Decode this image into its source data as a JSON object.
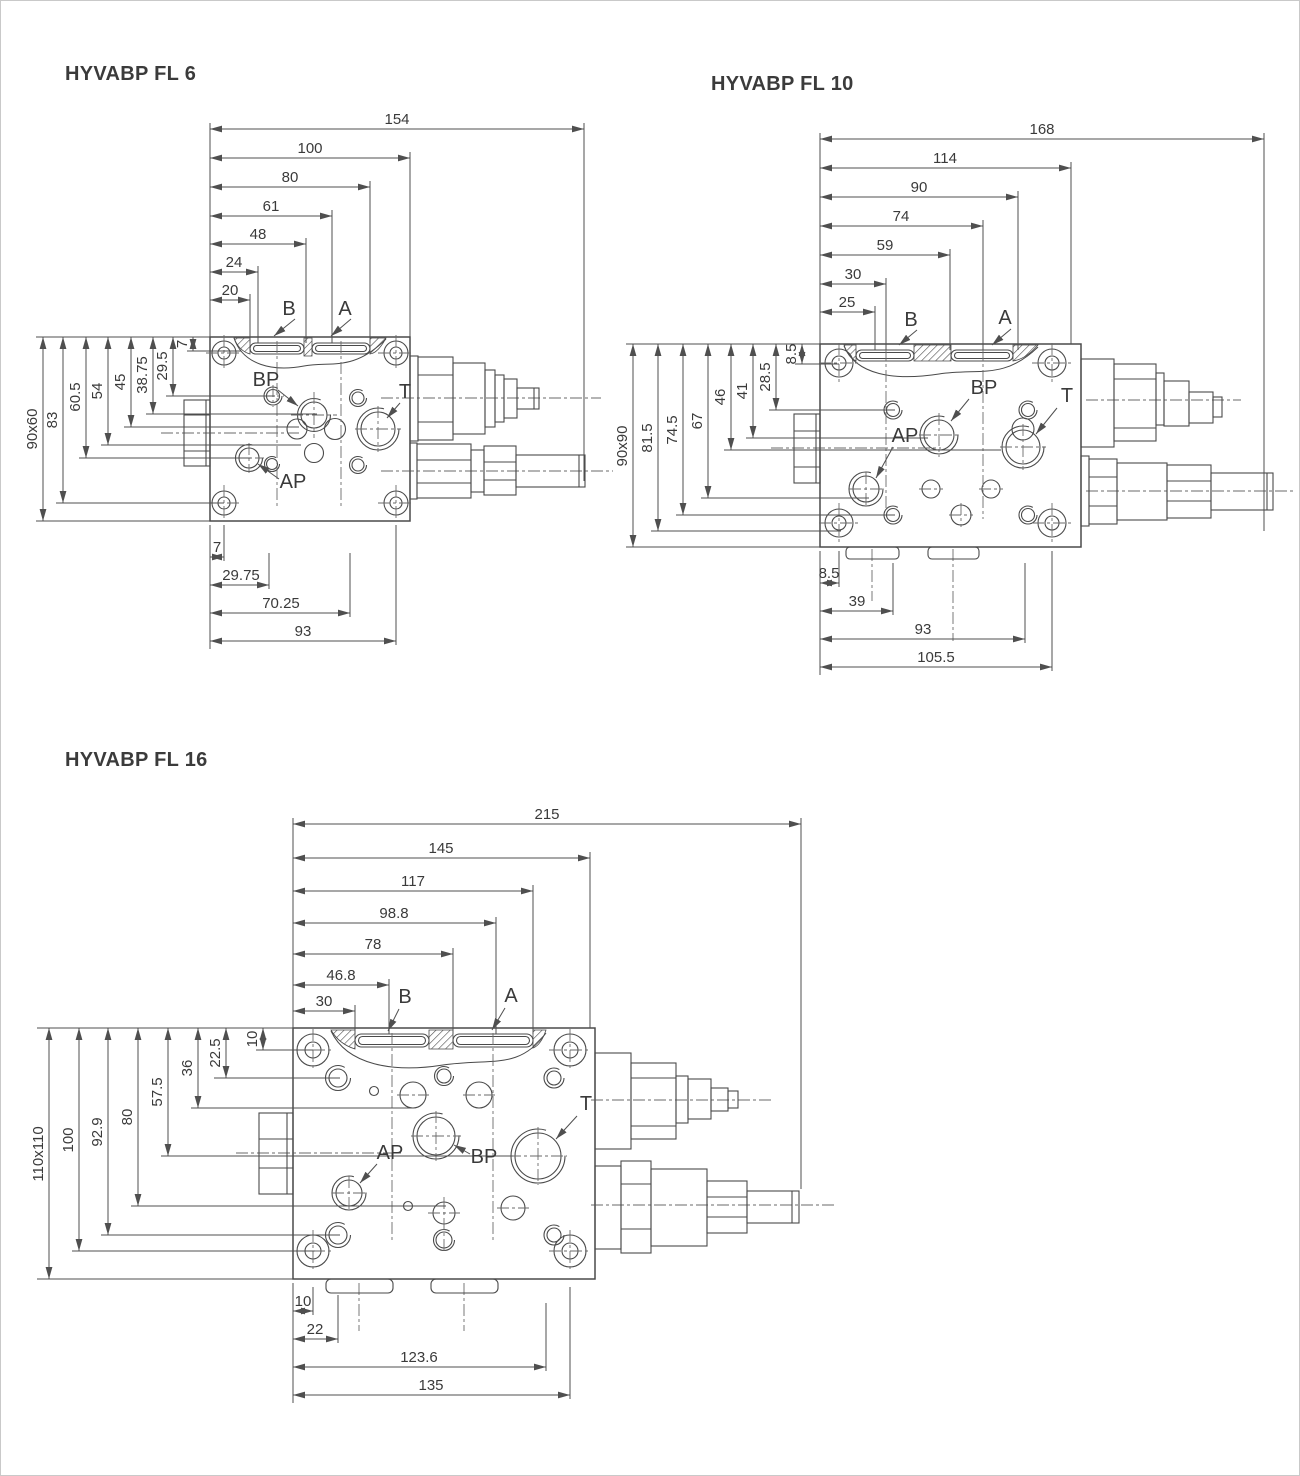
{
  "colors": {
    "line": "#4a4a4a",
    "text": "#3a3a3a",
    "background": "#ffffff",
    "frame": "#c9c9c9"
  },
  "diagrams": [
    {
      "id": "fl6",
      "title": "HYVABP FL 6",
      "flange": "90x60",
      "top_dims": [
        "154",
        "100",
        "80",
        "61",
        "48",
        "24",
        "20"
      ],
      "left_dims": [
        "83",
        "60.5",
        "54",
        "45",
        "38.75",
        "29.5"
      ],
      "left_small_dim": "7",
      "bottom_dims": [
        "7",
        "29.75",
        "70.25",
        "93"
      ],
      "ports": {
        "b": "B",
        "a": "A",
        "bp": "BP",
        "ap": "AP",
        "t": "T"
      }
    },
    {
      "id": "fl10",
      "title": "HYVABP FL 10",
      "flange": "90x90",
      "top_dims": [
        "168",
        "114",
        "90",
        "74",
        "59",
        "30",
        "25"
      ],
      "left_dims": [
        "81.5",
        "74.5",
        "67",
        "46",
        "41",
        "28.5"
      ],
      "left_small_dim": "8.5",
      "bottom_dims": [
        "8.5",
        "39",
        "93",
        "105.5"
      ],
      "ports": {
        "b": "B",
        "a": "A",
        "bp": "BP",
        "ap": "AP",
        "t": "T"
      }
    },
    {
      "id": "fl16",
      "title": "HYVABP FL 16",
      "flange": "110x110",
      "top_dims": [
        "215",
        "145",
        "117",
        "98.8",
        "78",
        "46.8",
        "30"
      ],
      "left_dims": [
        "100",
        "92.9",
        "80",
        "57.5",
        "36",
        "22.5"
      ],
      "left_small_dim": "10",
      "bottom_dims": [
        "10",
        "22",
        "123.6",
        "135"
      ],
      "ports": {
        "b": "B",
        "a": "A",
        "bp": "BP",
        "ap": "AP",
        "t": "T"
      }
    }
  ]
}
